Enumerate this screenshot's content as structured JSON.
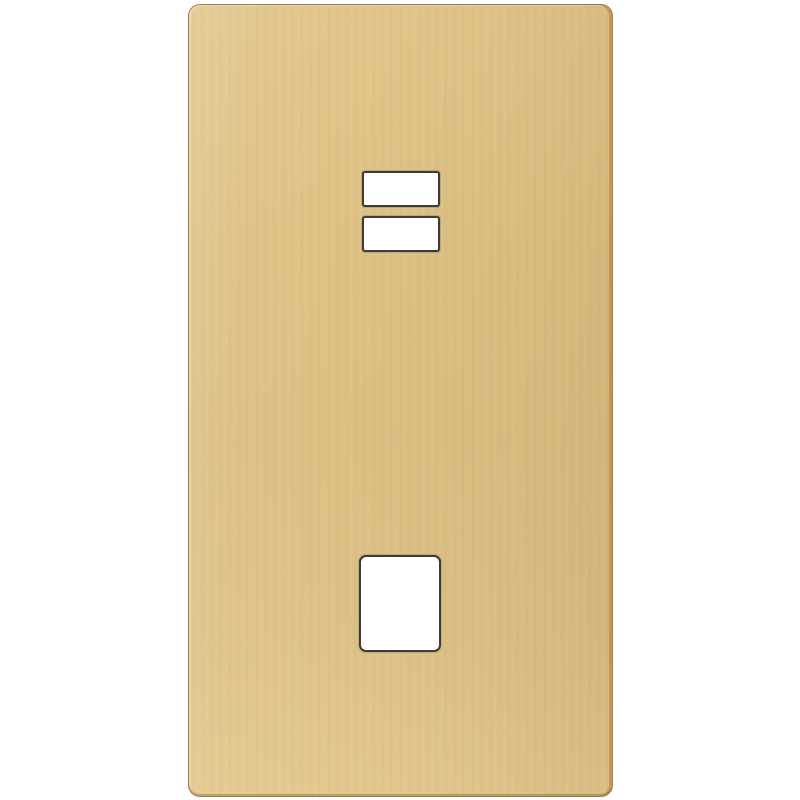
{
  "image": {
    "type": "product-photo",
    "alt": "Polished brass wall plate with two rectangular rocker switch openings near the top and one square module opening near the bottom, photographed on a plain white background",
    "background_color": "#ffffff",
    "visible_text": ""
  },
  "object": {
    "name": "brass wall plate",
    "finish": "polished brass / satin gold with fine vertical brushed streaks",
    "orientation": "portrait rectangle with rounded corners",
    "colors": {
      "plate_base": "#dcc084",
      "plate_highlight": "#e9d39c",
      "plate_shadow": "#d3b375",
      "outline_edge": "#5f4623",
      "right_side_copper_edge": "#ba7a30",
      "cutout_fill": "#ffffff",
      "cutout_rim": "#3c3c38"
    },
    "cutouts": [
      {
        "name": "rocker-opening-upper",
        "shape": "rectangle",
        "position": "upper center"
      },
      {
        "name": "rocker-opening-lower",
        "shape": "rectangle",
        "position": "upper center, just below upper opening"
      },
      {
        "name": "module-opening",
        "shape": "rounded square",
        "position": "lower center"
      }
    ]
  }
}
